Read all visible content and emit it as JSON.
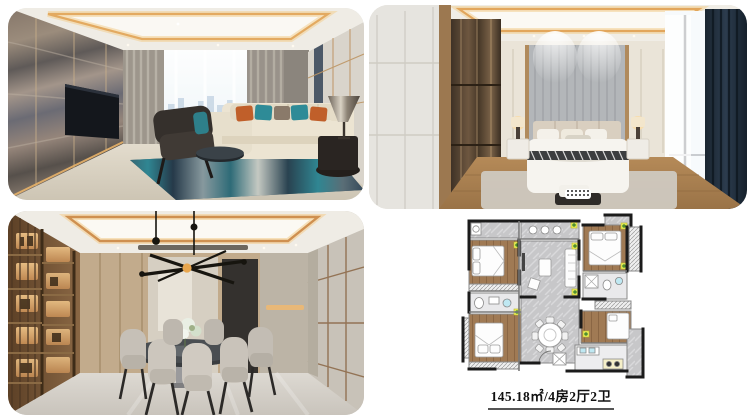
{
  "canvas": {
    "width": 756,
    "height": 420,
    "background": "#ffffff"
  },
  "collage": {
    "photos": [
      {
        "name": "living-room",
        "position": "top-left"
      },
      {
        "name": "bedroom",
        "position": "top-right"
      },
      {
        "name": "dining-room",
        "position": "bottom-left"
      }
    ],
    "floor_plan": {
      "position": "bottom-right",
      "caption": "145.18㎡/4房2厅2卫",
      "area": "145.18㎡",
      "rooms_spec": "4房2厅2卫"
    }
  },
  "colors": {
    "cove_light": "#e2a65c",
    "teal_accent": "#2e8b97",
    "orange_accent": "#c05f2a",
    "navy_accent": "#3c4a5c",
    "navy_curtain": "#22303f",
    "wood": "#a57c50",
    "plan_wood_floor": "#a07a54",
    "plan_marble_floor": "#c7c7c9",
    "plan_wall": "#1b1b1b",
    "plan_plant": "#f2f25e"
  }
}
